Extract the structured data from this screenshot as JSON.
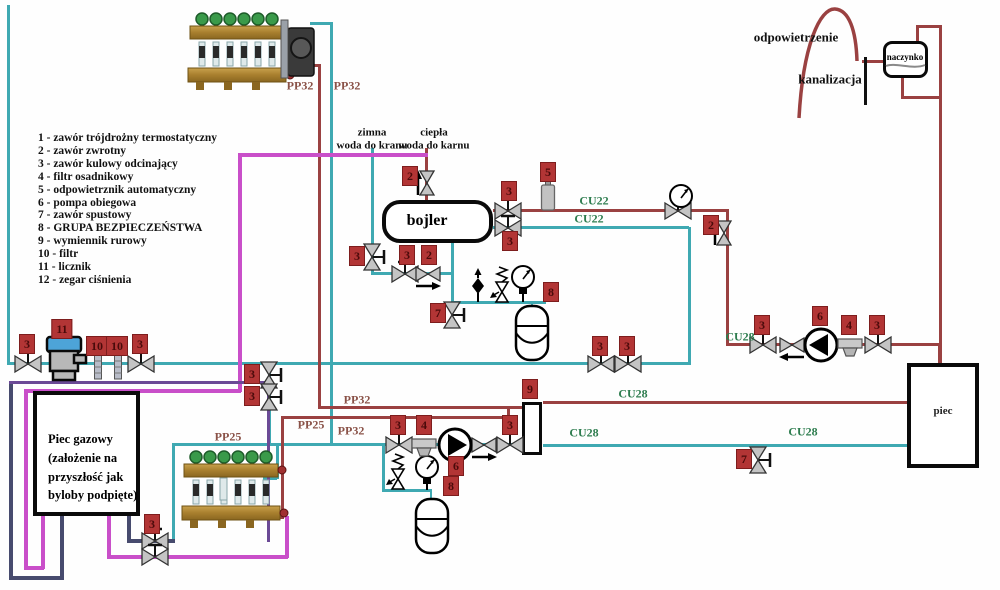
{
  "legend": {
    "items": [
      "1 - zawór trójdrożny termostatyczny",
      "2 - zawór zwrotny",
      "3 - zawór kulowy odcinający",
      "4 - filtr osadnikowy",
      "5 - odpowietrznik automatyczny",
      "6 - pompa obiegowa",
      "7 - zawór spustowy",
      "8 - GRUPA BEZPIECZEŃSTWA",
      "9 - wymiennik rurowy",
      "10 - filtr",
      "11 - licznik",
      "12 - zegar ciśnienia"
    ]
  },
  "boxes": {
    "bojler": "bojler",
    "piec": "piec",
    "naczynko": "naczynko",
    "piec_gazowy": "Piec gazowy\n(założenie na\nprzyszłość jak\nbyloby podpięte)"
  },
  "annotations": {
    "zimna": "zimna\nwoda do kranu",
    "ciepla": "ciepła\nwoda do karnu",
    "odpowietrzenie": "odpowietrzenie",
    "kanalizacja": "kanalizacja"
  },
  "component_tags": [
    {
      "t": "3",
      "x": 27,
      "y": 344
    },
    {
      "t": "11",
      "x": 62,
      "y": 329
    },
    {
      "t": "10",
      "x": 97,
      "y": 346
    },
    {
      "t": "10",
      "x": 117,
      "y": 346
    },
    {
      "t": "3",
      "x": 140,
      "y": 344
    },
    {
      "t": "3",
      "x": 600,
      "y": 346
    },
    {
      "t": "3",
      "x": 627,
      "y": 346
    },
    {
      "t": "2",
      "x": 410,
      "y": 176
    },
    {
      "t": "3",
      "x": 509,
      "y": 191
    },
    {
      "t": "3",
      "x": 510,
      "y": 241
    },
    {
      "t": "5",
      "x": 548,
      "y": 172
    },
    {
      "t": "2",
      "x": 711,
      "y": 225
    },
    {
      "t": "3",
      "x": 357,
      "y": 256
    },
    {
      "t": "3",
      "x": 407,
      "y": 255
    },
    {
      "t": "2",
      "x": 429,
      "y": 255
    },
    {
      "t": "7",
      "x": 438,
      "y": 313
    },
    {
      "t": "8",
      "x": 551,
      "y": 292
    },
    {
      "t": "3",
      "x": 252,
      "y": 374
    },
    {
      "t": "3",
      "x": 252,
      "y": 396
    },
    {
      "t": "9",
      "x": 530,
      "y": 389
    },
    {
      "t": "3",
      "x": 398,
      "y": 425
    },
    {
      "t": "4",
      "x": 424,
      "y": 425
    },
    {
      "t": "6",
      "x": 456,
      "y": 466
    },
    {
      "t": "8",
      "x": 451,
      "y": 486
    },
    {
      "t": "3",
      "x": 510,
      "y": 425
    },
    {
      "t": "3",
      "x": 762,
      "y": 325
    },
    {
      "t": "6",
      "x": 820,
      "y": 316
    },
    {
      "t": "4",
      "x": 849,
      "y": 325
    },
    {
      "t": "3",
      "x": 877,
      "y": 325
    },
    {
      "t": "7",
      "x": 744,
      "y": 459
    },
    {
      "t": "3",
      "x": 152,
      "y": 524
    }
  ],
  "pipe_labels": [
    {
      "t": "PP32",
      "x": 300,
      "y": 86,
      "k": "pp"
    },
    {
      "t": "PP32",
      "x": 347,
      "y": 86,
      "k": "pp"
    },
    {
      "t": "PP32",
      "x": 357,
      "y": 400,
      "k": "pp"
    },
    {
      "t": "PP25",
      "x": 311,
      "y": 425,
      "k": "pp"
    },
    {
      "t": "PP32",
      "x": 351,
      "y": 431,
      "k": "pp"
    },
    {
      "t": "PP25",
      "x": 228,
      "y": 437,
      "k": "pp"
    },
    {
      "t": "CU22",
      "x": 594,
      "y": 201,
      "k": "cu"
    },
    {
      "t": "CU22",
      "x": 589,
      "y": 219,
      "k": "cu"
    },
    {
      "t": "CU28",
      "x": 633,
      "y": 394,
      "k": "cu"
    },
    {
      "t": "CU28",
      "x": 584,
      "y": 433,
      "k": "cu"
    },
    {
      "t": "CU28",
      "x": 803,
      "y": 432,
      "k": "cu"
    },
    {
      "t": "CU28",
      "x": 740,
      "y": 337,
      "k": "cu"
    }
  ],
  "colors": {
    "pipe_teal": "#3fa9b2",
    "pipe_red": "#9a4141",
    "pipe_magenta": "#c94fc9",
    "pipe_navy": "#474b6e",
    "pipe_purple": "#6b4a96",
    "tag_red": "#b23535",
    "label_cu_green": "#2e7d4f",
    "label_pp_brown": "#8a5248"
  }
}
